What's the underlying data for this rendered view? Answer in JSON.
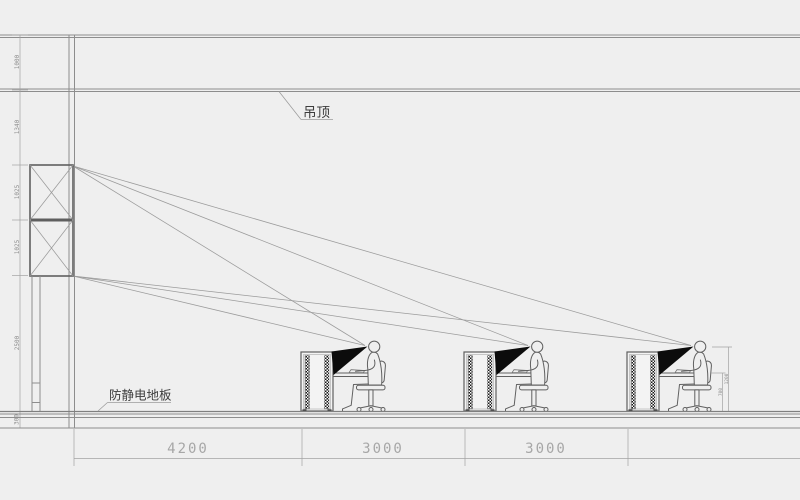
{
  "labels": {
    "ceiling": "吊顶",
    "floor": "防静电地板"
  },
  "dimensions": {
    "left_chain": [
      "1000",
      "1340",
      "1025",
      "1025",
      "2500",
      "300"
    ],
    "bottom": [
      "4200",
      "3000",
      "3000"
    ],
    "right": {
      "eye_height": "1200",
      "desk_height": "700"
    }
  },
  "workstations": {
    "count": "3"
  },
  "colors": {
    "background": "#efefef",
    "line_gray": "#8d8d8d",
    "dim_text_gray": "#a7a7a7",
    "label_dark": "#3d3d3d",
    "view_cone_black": "#0c0c0c"
  }
}
